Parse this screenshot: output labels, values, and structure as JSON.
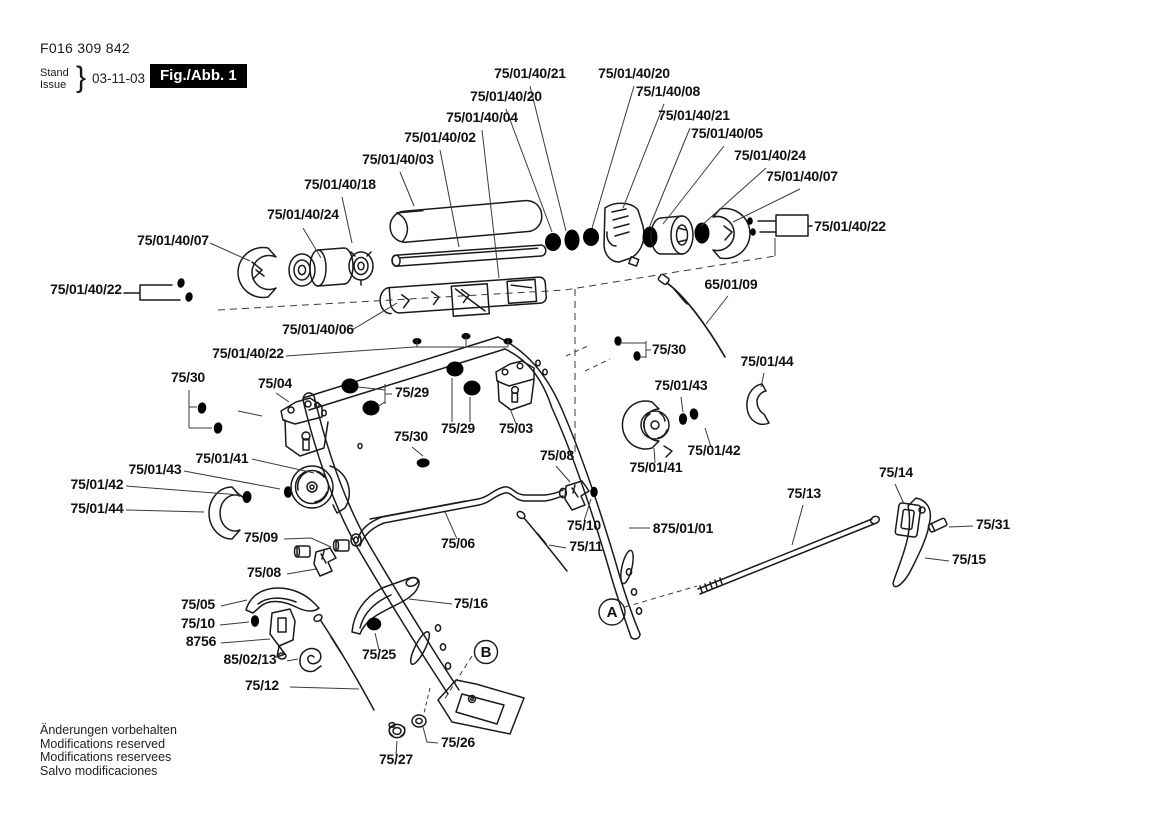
{
  "header": {
    "doc_number": "F016 309 842",
    "stand": "Stand",
    "issue": "Issue",
    "brace": "}",
    "date": "03-11-03",
    "fig_label": "Fig./Abb. 1"
  },
  "footer": {
    "line1": "Änderungen vorbehalten",
    "line2": "Modifications reserved",
    "line3": "Modifications reservees",
    "line4": "Salvo modificaciones"
  },
  "colors": {
    "ink": "#1a1a1a",
    "background": "#ffffff",
    "fig_box_bg": "#000000",
    "fig_box_text": "#ffffff"
  },
  "callouts": {
    "a": "A",
    "b": "B"
  },
  "labels": [
    {
      "text": "75/01/40/21"
    },
    {
      "text": "75/01/40/20"
    },
    {
      "text": "75/01/40/20"
    },
    {
      "text": "75/1/40/08"
    },
    {
      "text": "75/01/40/04"
    },
    {
      "text": "75/01/40/21"
    },
    {
      "text": "75/01/40/02"
    },
    {
      "text": "75/01/40/05"
    },
    {
      "text": "75/01/40/03"
    },
    {
      "text": "75/01/40/24"
    },
    {
      "text": "75/01/40/18"
    },
    {
      "text": "75/01/40/07"
    },
    {
      "text": "75/01/40/24"
    },
    {
      "text": "75/01/40/22"
    },
    {
      "text": "75/01/40/07"
    },
    {
      "text": "75/01/40/22"
    },
    {
      "text": "75/01/40/06"
    },
    {
      "text": "75/01/40/22"
    },
    {
      "text": "75/30"
    },
    {
      "text": "75/04"
    },
    {
      "text": "75/29"
    },
    {
      "text": "75/30"
    },
    {
      "text": "75/01/43"
    },
    {
      "text": "75/01/44"
    },
    {
      "text": "65/01/09"
    },
    {
      "text": "75/29"
    },
    {
      "text": "75/03"
    },
    {
      "text": "75/30"
    },
    {
      "text": "75/08"
    },
    {
      "text": "75/01/41"
    },
    {
      "text": "75/01/42"
    },
    {
      "text": "75/01/41"
    },
    {
      "text": "75/01/43"
    },
    {
      "text": "75/01/42"
    },
    {
      "text": "75/01/44"
    },
    {
      "text": "875/01/01"
    },
    {
      "text": "75/13"
    },
    {
      "text": "75/14"
    },
    {
      "text": "75/31"
    },
    {
      "text": "75/15"
    },
    {
      "text": "75/09"
    },
    {
      "text": "75/08"
    },
    {
      "text": "75/06"
    },
    {
      "text": "75/10"
    },
    {
      "text": "75/11"
    },
    {
      "text": "75/05"
    },
    {
      "text": "75/10"
    },
    {
      "text": "8756"
    },
    {
      "text": "85/02/13"
    },
    {
      "text": "75/12"
    },
    {
      "text": "75/25"
    },
    {
      "text": "75/16"
    },
    {
      "text": "75/26"
    },
    {
      "text": "75/27"
    }
  ]
}
